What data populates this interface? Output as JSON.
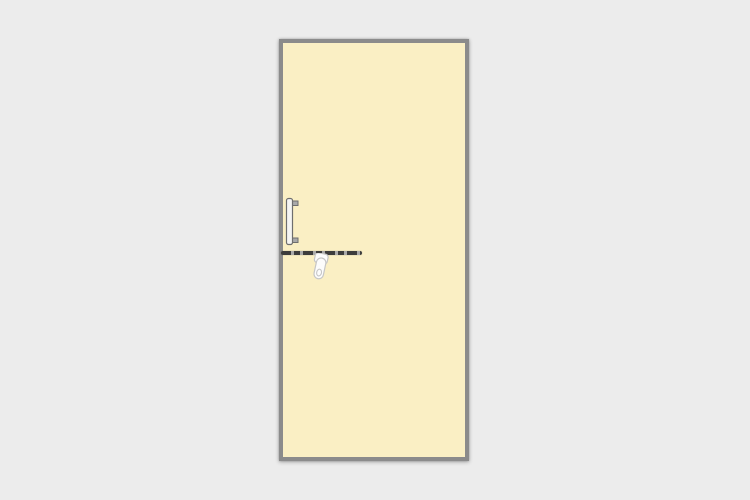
{
  "scene": {
    "description_labels": {
      "door_panel": "door-panel",
      "pull_handle": "pull-handle-icon",
      "handle_height_line": "handle-height-reference-line",
      "lever_handle": "lever-handle-icon"
    }
  },
  "colors": {
    "canvas-bg": "#ECECEC",
    "door-fill": "#FAEFC4",
    "door-border": "#8B8B8B",
    "line-dark": "#3C3C3C",
    "line-light": "#A9A9A9",
    "handle-fill": "#F5F5F3",
    "handle-arm": "#A9A9A9",
    "handle-stroke": "#6E6E6E",
    "lever-fill": "#FCFCFC",
    "lever-stroke": "#C6C6C6"
  }
}
